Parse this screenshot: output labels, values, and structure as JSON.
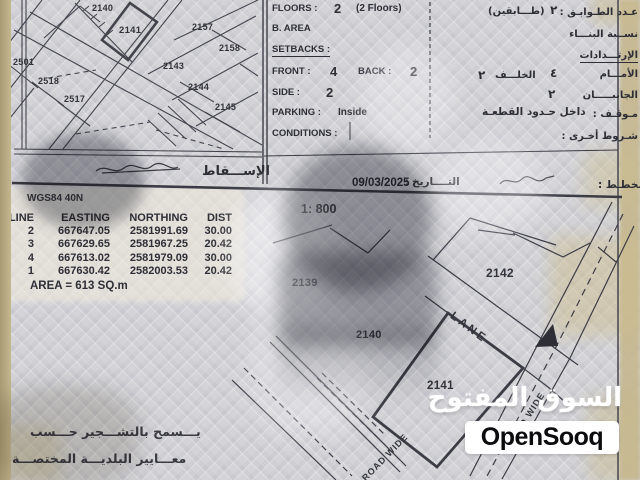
{
  "specs": {
    "floors_label": "FLOORS :",
    "floors_value": "2",
    "floors_note": "(2 Floors)",
    "floors_ar_note": "(طـــابقين)",
    "floors_ar_value": "٢",
    "floors_ar_label": "عـدد الطـوابـق :",
    "barea_label": "B. AREA",
    "barea_ar_label": "نســبة البنـــاء",
    "setbacks_label": "SETBACKS :",
    "setbacks_ar_label": "الإرتـــدادات",
    "front_label": "FRONT :",
    "front_value": "4",
    "back_label": "BACK :",
    "back_value": "2",
    "back_ar_value": "٢",
    "back_ar_label": "الخلـــف",
    "front_ar_value": "٤",
    "front_ar_label": "الأمـــام",
    "side_label": "SIDE :",
    "side_value": "2",
    "side_ar_value": "٢",
    "side_ar_label": "الجانبـــــان",
    "parking_label": "PARKING :",
    "parking_value": "Inside",
    "parking_ar_value": "داخل حـدود القطعـة",
    "parking_ar_label": "مـوقـف :",
    "conditions_label": "CONDITIONS :",
    "conditions_ar_label": "شـروط أخـرى :"
  },
  "band": {
    "projection_ar": "الإســـقاط",
    "date_value": "09/03/2025",
    "date_sep": ":",
    "date_ar_label": "التــــاريخ",
    "planner_ar_label": "المخطـط :"
  },
  "survey": {
    "datum": "WGS84 40N",
    "scale": "1: 800",
    "headers": [
      "LINE",
      "EASTING",
      "NORTHING",
      "DIST"
    ],
    "rows": [
      [
        "2",
        "667647.05",
        "2581991.69",
        "30.00"
      ],
      [
        "3",
        "667629.65",
        "2581967.25",
        "20.42"
      ],
      [
        "4",
        "667613.02",
        "2581979.09",
        "30.00"
      ],
      [
        "1",
        "667630.42",
        "2582003.53",
        "20.42"
      ]
    ],
    "area_note": "AREA = 613  SQ.m"
  },
  "location_map": {
    "p2140": "2140",
    "p2141": "2141",
    "p2157": "2157",
    "p2158": "2158",
    "p2143": "2143",
    "p2144": "2144",
    "p2145": "2145",
    "p2501": "2501",
    "p2518": "2518",
    "p2517": "2517"
  },
  "site_plan": {
    "p2139": "2139",
    "p2140": "2140",
    "p2141": "2141",
    "p2142": "2142",
    "lane_label": "LANE",
    "road_label": "ROAD WIDE"
  },
  "notes": {
    "line1": "يـــسمح بالتشـــجير حـــسب",
    "line2": "معـــايير البلديـــة المختصـــة"
  },
  "watermark": {
    "ar": "السوق المفتوح",
    "en": "OpenSooq"
  },
  "colors": {
    "paper": "#d4d4d8",
    "page_edge_beige": "#c6b890",
    "ink": "#2e2e36",
    "watermark_box": "#ffffff",
    "subject_plot_outline": "#2e2e36"
  }
}
